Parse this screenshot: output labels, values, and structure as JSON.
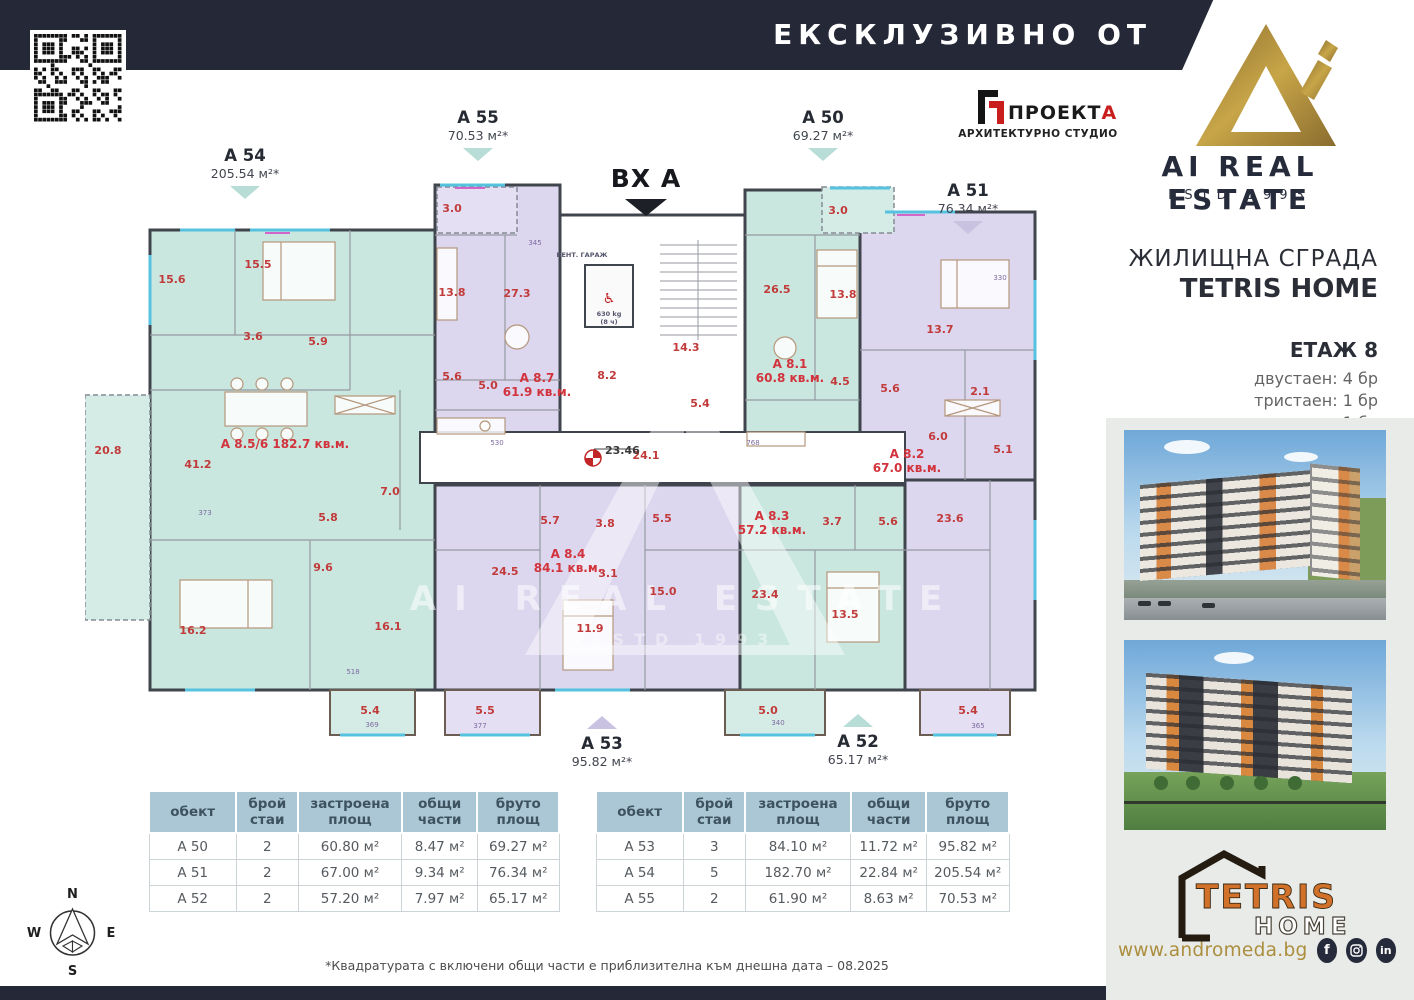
{
  "banner": {
    "exclusive": "ЕКСКЛУЗИВНО ОТ"
  },
  "brand": {
    "name": "AI REAL ESTATE",
    "estd": "ESTD 1993",
    "gold": "#a98b3f",
    "navy": "#252937"
  },
  "architect": {
    "name_main": "ПРОЕКТ",
    "name_accent": "А",
    "subtitle": "АРХИТЕКТУРНО СТУДИО"
  },
  "project": {
    "type": "ЖИЛИЩНА СГРАДА",
    "name": "TETRIS HOME",
    "floor": "ЕТАЖ 8",
    "mix": [
      "двустаен: 4 бр",
      "тристаен: 1 бр",
      "петстаен: 1 бр"
    ]
  },
  "plan": {
    "entrance": "ВХ А",
    "markers": [
      {
        "id": "A 54",
        "area": "205.54 м²*"
      },
      {
        "id": "A 55",
        "area": "70.53 м²*"
      },
      {
        "id": "A 50",
        "area": "69.27 м²*"
      },
      {
        "id": "A 51",
        "area": "76.34 м²*"
      },
      {
        "id": "A 53",
        "area": "95.82 м²*"
      },
      {
        "id": "A 52",
        "area": "65.17 м²*"
      }
    ],
    "lift": {
      "capacity": "630 kg",
      "persons": "(8 ч)"
    },
    "core_label": "ВЕНТ. ГАРАЖ",
    "level_mark": "23.46",
    "colors": {
      "teal": "#c9e6df",
      "lavender": "#dcd6ee",
      "wall": "#40454d",
      "room_label": "#c23b3b"
    },
    "labels": [
      {
        "t": "20.8",
        "x": 23,
        "y": 354,
        "c": "r"
      },
      {
        "t": "15.6",
        "x": 87,
        "y": 183,
        "c": "r"
      },
      {
        "t": "15.5",
        "x": 173,
        "y": 168,
        "c": "r"
      },
      {
        "t": "3.6",
        "x": 168,
        "y": 240,
        "c": "r"
      },
      {
        "t": "5.9",
        "x": 233,
        "y": 245,
        "c": "r"
      },
      {
        "t": "41.2",
        "x": 113,
        "y": 368,
        "c": "r"
      },
      {
        "t": "7.0",
        "x": 305,
        "y": 395,
        "c": "r"
      },
      {
        "t": "5.8",
        "x": 243,
        "y": 421,
        "c": "r"
      },
      {
        "t": "9.6",
        "x": 238,
        "y": 471,
        "c": "r"
      },
      {
        "t": "16.2",
        "x": 108,
        "y": 534,
        "c": "r"
      },
      {
        "t": "16.1",
        "x": 303,
        "y": 530,
        "c": "r"
      },
      {
        "t": "5.4",
        "x": 285,
        "y": 614,
        "c": "r"
      },
      {
        "t": "3.0",
        "x": 367,
        "y": 112,
        "c": "r"
      },
      {
        "t": "13.8",
        "x": 367,
        "y": 196,
        "c": "r"
      },
      {
        "t": "27.3",
        "x": 432,
        "y": 197,
        "c": "r"
      },
      {
        "t": "5.6",
        "x": 367,
        "y": 280,
        "c": "r"
      },
      {
        "t": "5.0",
        "x": 403,
        "y": 289,
        "c": "r"
      },
      {
        "t": "8.2",
        "x": 522,
        "y": 279,
        "c": "r"
      },
      {
        "t": "14.3",
        "x": 601,
        "y": 251,
        "c": "r"
      },
      {
        "t": "5.4",
        "x": 615,
        "y": 307,
        "c": "r"
      },
      {
        "t": "24.1",
        "x": 561,
        "y": 359,
        "c": "r"
      },
      {
        "t": "26.5",
        "x": 692,
        "y": 193,
        "c": "r"
      },
      {
        "t": "13.8",
        "x": 758,
        "y": 198,
        "c": "r"
      },
      {
        "t": "4.5",
        "x": 755,
        "y": 285,
        "c": "r"
      },
      {
        "t": "5.6",
        "x": 805,
        "y": 292,
        "c": "r"
      },
      {
        "t": "3.0",
        "x": 753,
        "y": 114,
        "c": "r"
      },
      {
        "t": "13.7",
        "x": 855,
        "y": 233,
        "c": "r"
      },
      {
        "t": "2.1",
        "x": 895,
        "y": 295,
        "c": "r"
      },
      {
        "t": "5.1",
        "x": 918,
        "y": 353,
        "c": "r"
      },
      {
        "t": "6.0",
        "x": 853,
        "y": 340,
        "c": "r"
      },
      {
        "t": "23.6",
        "x": 865,
        "y": 422,
        "c": "r"
      },
      {
        "t": "5.4",
        "x": 883,
        "y": 614,
        "c": "r"
      },
      {
        "t": "5.7",
        "x": 465,
        "y": 424,
        "c": "r"
      },
      {
        "t": "3.8",
        "x": 520,
        "y": 427,
        "c": "r"
      },
      {
        "t": "5.5",
        "x": 577,
        "y": 422,
        "c": "r"
      },
      {
        "t": "24.5",
        "x": 420,
        "y": 475,
        "c": "r"
      },
      {
        "t": "3.1",
        "x": 523,
        "y": 477,
        "c": "r"
      },
      {
        "t": "11.9",
        "x": 505,
        "y": 532,
        "c": "r"
      },
      {
        "t": "15.0",
        "x": 578,
        "y": 495,
        "c": "r"
      },
      {
        "t": "5.5",
        "x": 400,
        "y": 614,
        "c": "r"
      },
      {
        "t": "3.7",
        "x": 747,
        "y": 425,
        "c": "r"
      },
      {
        "t": "5.6",
        "x": 803,
        "y": 425,
        "c": "r"
      },
      {
        "t": "23.4",
        "x": 680,
        "y": 498,
        "c": "r"
      },
      {
        "t": "13.5",
        "x": 760,
        "y": 518,
        "c": "r"
      },
      {
        "t": "5.0",
        "x": 683,
        "y": 614,
        "c": "r"
      },
      {
        "t": "А 8.5/6  182.7 кв.м.",
        "x": 200,
        "y": 348,
        "c": "a"
      },
      {
        "t": "А 8.7",
        "x": 452,
        "y": 282,
        "c": "a"
      },
      {
        "t": "61.9 кв.м.",
        "x": 452,
        "y": 296,
        "c": "a"
      },
      {
        "t": "А 8.1",
        "x": 705,
        "y": 268,
        "c": "a"
      },
      {
        "t": "60.8 кв.м.",
        "x": 705,
        "y": 282,
        "c": "a"
      },
      {
        "t": "А 8.2",
        "x": 822,
        "y": 358,
        "c": "a"
      },
      {
        "t": "67.0 кв.м.",
        "x": 822,
        "y": 372,
        "c": "a"
      },
      {
        "t": "А 8.4",
        "x": 483,
        "y": 458,
        "c": "a"
      },
      {
        "t": "84.1 кв.м.",
        "x": 483,
        "y": 472,
        "c": "a"
      },
      {
        "t": "А 8.3",
        "x": 687,
        "y": 420,
        "c": "a"
      },
      {
        "t": "57.2 кв.м.",
        "x": 687,
        "y": 434,
        "c": "a"
      },
      {
        "t": "530",
        "x": 412,
        "y": 345,
        "c": "d"
      },
      {
        "t": "768",
        "x": 668,
        "y": 345,
        "c": "d"
      },
      {
        "t": "340",
        "x": 693,
        "y": 625,
        "c": "d"
      },
      {
        "t": "365",
        "x": 893,
        "y": 628,
        "c": "d"
      },
      {
        "t": "377",
        "x": 395,
        "y": 628,
        "c": "d"
      },
      {
        "t": "369",
        "x": 287,
        "y": 627,
        "c": "d"
      },
      {
        "t": "518",
        "x": 268,
        "y": 574,
        "c": "d"
      },
      {
        "t": "373",
        "x": 120,
        "y": 415,
        "c": "d"
      },
      {
        "t": "330",
        "x": 915,
        "y": 180,
        "c": "d"
      },
      {
        "t": "345",
        "x": 450,
        "y": 145,
        "c": "d"
      },
      {
        "t": "ВЕНТ. ГАРАЖ",
        "x": 497,
        "y": 157,
        "c": "c"
      },
      {
        "t": "630 kg",
        "x": 524,
        "y": 216,
        "c": "c"
      },
      {
        "t": "(8 ч)",
        "x": 524,
        "y": 224,
        "c": "c"
      },
      {
        "t": "23.46",
        "x": 520,
        "y": 354,
        "c": "l"
      }
    ]
  },
  "tables": {
    "headers": [
      "обект",
      "брой стаи",
      "застроена площ",
      "общи части",
      "бруто площ"
    ],
    "left": [
      [
        "A 50",
        "2",
        "60.80 м²",
        "8.47 м²",
        "69.27 м²"
      ],
      [
        "A 51",
        "2",
        "67.00 м²",
        "9.34 м²",
        "76.34 м²"
      ],
      [
        "A 52",
        "2",
        "57.20 м²",
        "7.97 м²",
        "65.17 м²"
      ]
    ],
    "right": [
      [
        "A 53",
        "3",
        "84.10 м²",
        "11.72 м²",
        "95.82 м²"
      ],
      [
        "A 54",
        "5",
        "182.70 м²",
        "22.84 м²",
        "205.54 м²"
      ],
      [
        "A 55",
        "2",
        "61.90 м²",
        "8.63 м²",
        "70.53 м²"
      ]
    ]
  },
  "compass": {
    "n": "N",
    "e": "E",
    "s": "S",
    "w": "W"
  },
  "footnote": "*Квадратурата с включени общи части е приблизителна към днешна дата – 08.2025",
  "footer": {
    "logo_line1": "TETRIS",
    "logo_line2": "HOME",
    "website": "www.andromeda.bg",
    "social": [
      "facebook",
      "instagram",
      "linkedin"
    ]
  }
}
